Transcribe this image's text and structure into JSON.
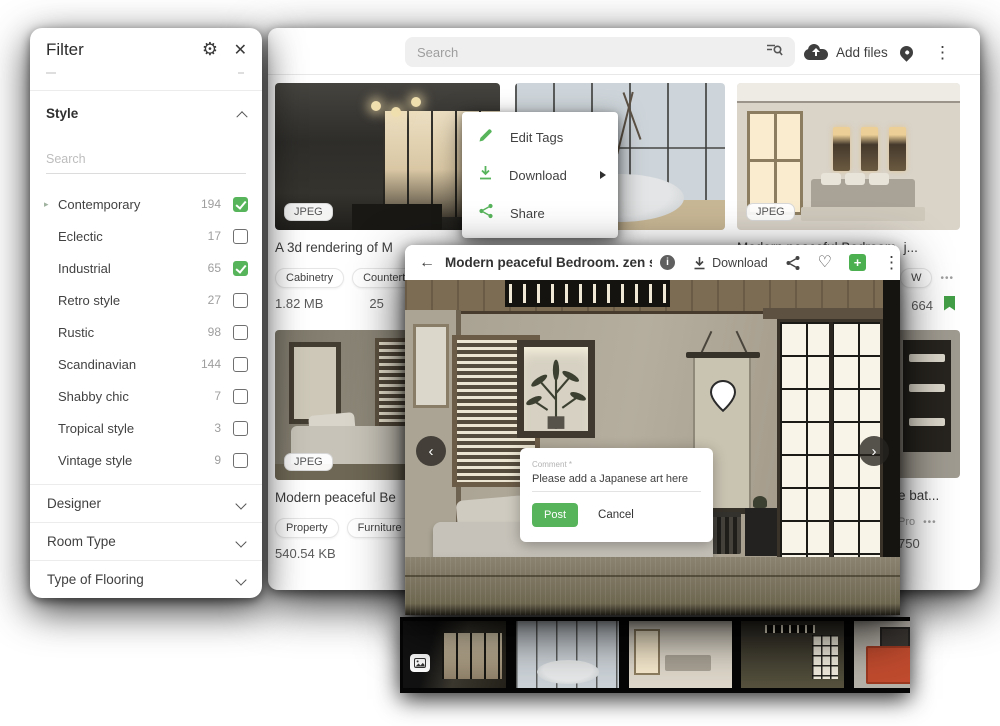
{
  "colors": {
    "accent_green": "#57B45B",
    "green_plus": "#4CAF50",
    "bookmark_green": "#43A047"
  },
  "icons": {
    "gear": "⚙",
    "close": "✕",
    "back": "←",
    "dots_v": "⋮",
    "heart": "♡",
    "chevron_left": "‹",
    "chevron_right": "›",
    "plus": "+",
    "info": "i",
    "more": "•••",
    "caret": "▸"
  },
  "topbar": {
    "search_placeholder": "Search",
    "add_files_label": "Add files"
  },
  "filter": {
    "title": "Filter",
    "style_section": {
      "label": "Style",
      "search_placeholder": "Search",
      "items": [
        {
          "label": "Contemporary",
          "count": "194",
          "checked": true
        },
        {
          "label": "Eclectic",
          "count": "17",
          "checked": false
        },
        {
          "label": "Industrial",
          "count": "65",
          "checked": true
        },
        {
          "label": "Retro style",
          "count": "27",
          "checked": false
        },
        {
          "label": "Rustic",
          "count": "98",
          "checked": false
        },
        {
          "label": "Scandinavian",
          "count": "144",
          "checked": false
        },
        {
          "label": "Shabby chic",
          "count": "7",
          "checked": false
        },
        {
          "label": "Tropical style",
          "count": "3",
          "checked": false
        },
        {
          "label": "Vintage style",
          "count": "9",
          "checked": false
        }
      ]
    },
    "collapsed": [
      {
        "label": "Designer"
      },
      {
        "label": "Room Type"
      },
      {
        "label": "Type of Flooring"
      }
    ]
  },
  "context_menu": {
    "items": [
      {
        "label": "Edit Tags"
      },
      {
        "label": "Download"
      },
      {
        "label": "Share"
      }
    ]
  },
  "cards": {
    "kitchen": {
      "badge": "JPEG",
      "title": "A 3d rendering of M",
      "tags": [
        "Cabinetry",
        "Countertop"
      ],
      "size": "1.82 MB",
      "extra": "25"
    },
    "niche": {
      "badge": "JPEG",
      "title": "Modern peaceful Bedroom. j...",
      "tag": "W",
      "size": "664"
    },
    "zen": {
      "badge": "JPEG",
      "title": "Modern peaceful Be",
      "tags": [
        "Property",
        "Furniture"
      ],
      "size": "540.54 KB"
    },
    "shelf": {
      "title": "e bat...",
      "tag": "Pro",
      "size": "750"
    }
  },
  "modal": {
    "title": "Modern peaceful Bedroom. zen style bed...",
    "download_label": "Download"
  },
  "comment_popup": {
    "label": "Comment *",
    "value": "Please add a Japanese art here",
    "post_label": "Post",
    "cancel_label": "Cancel"
  }
}
